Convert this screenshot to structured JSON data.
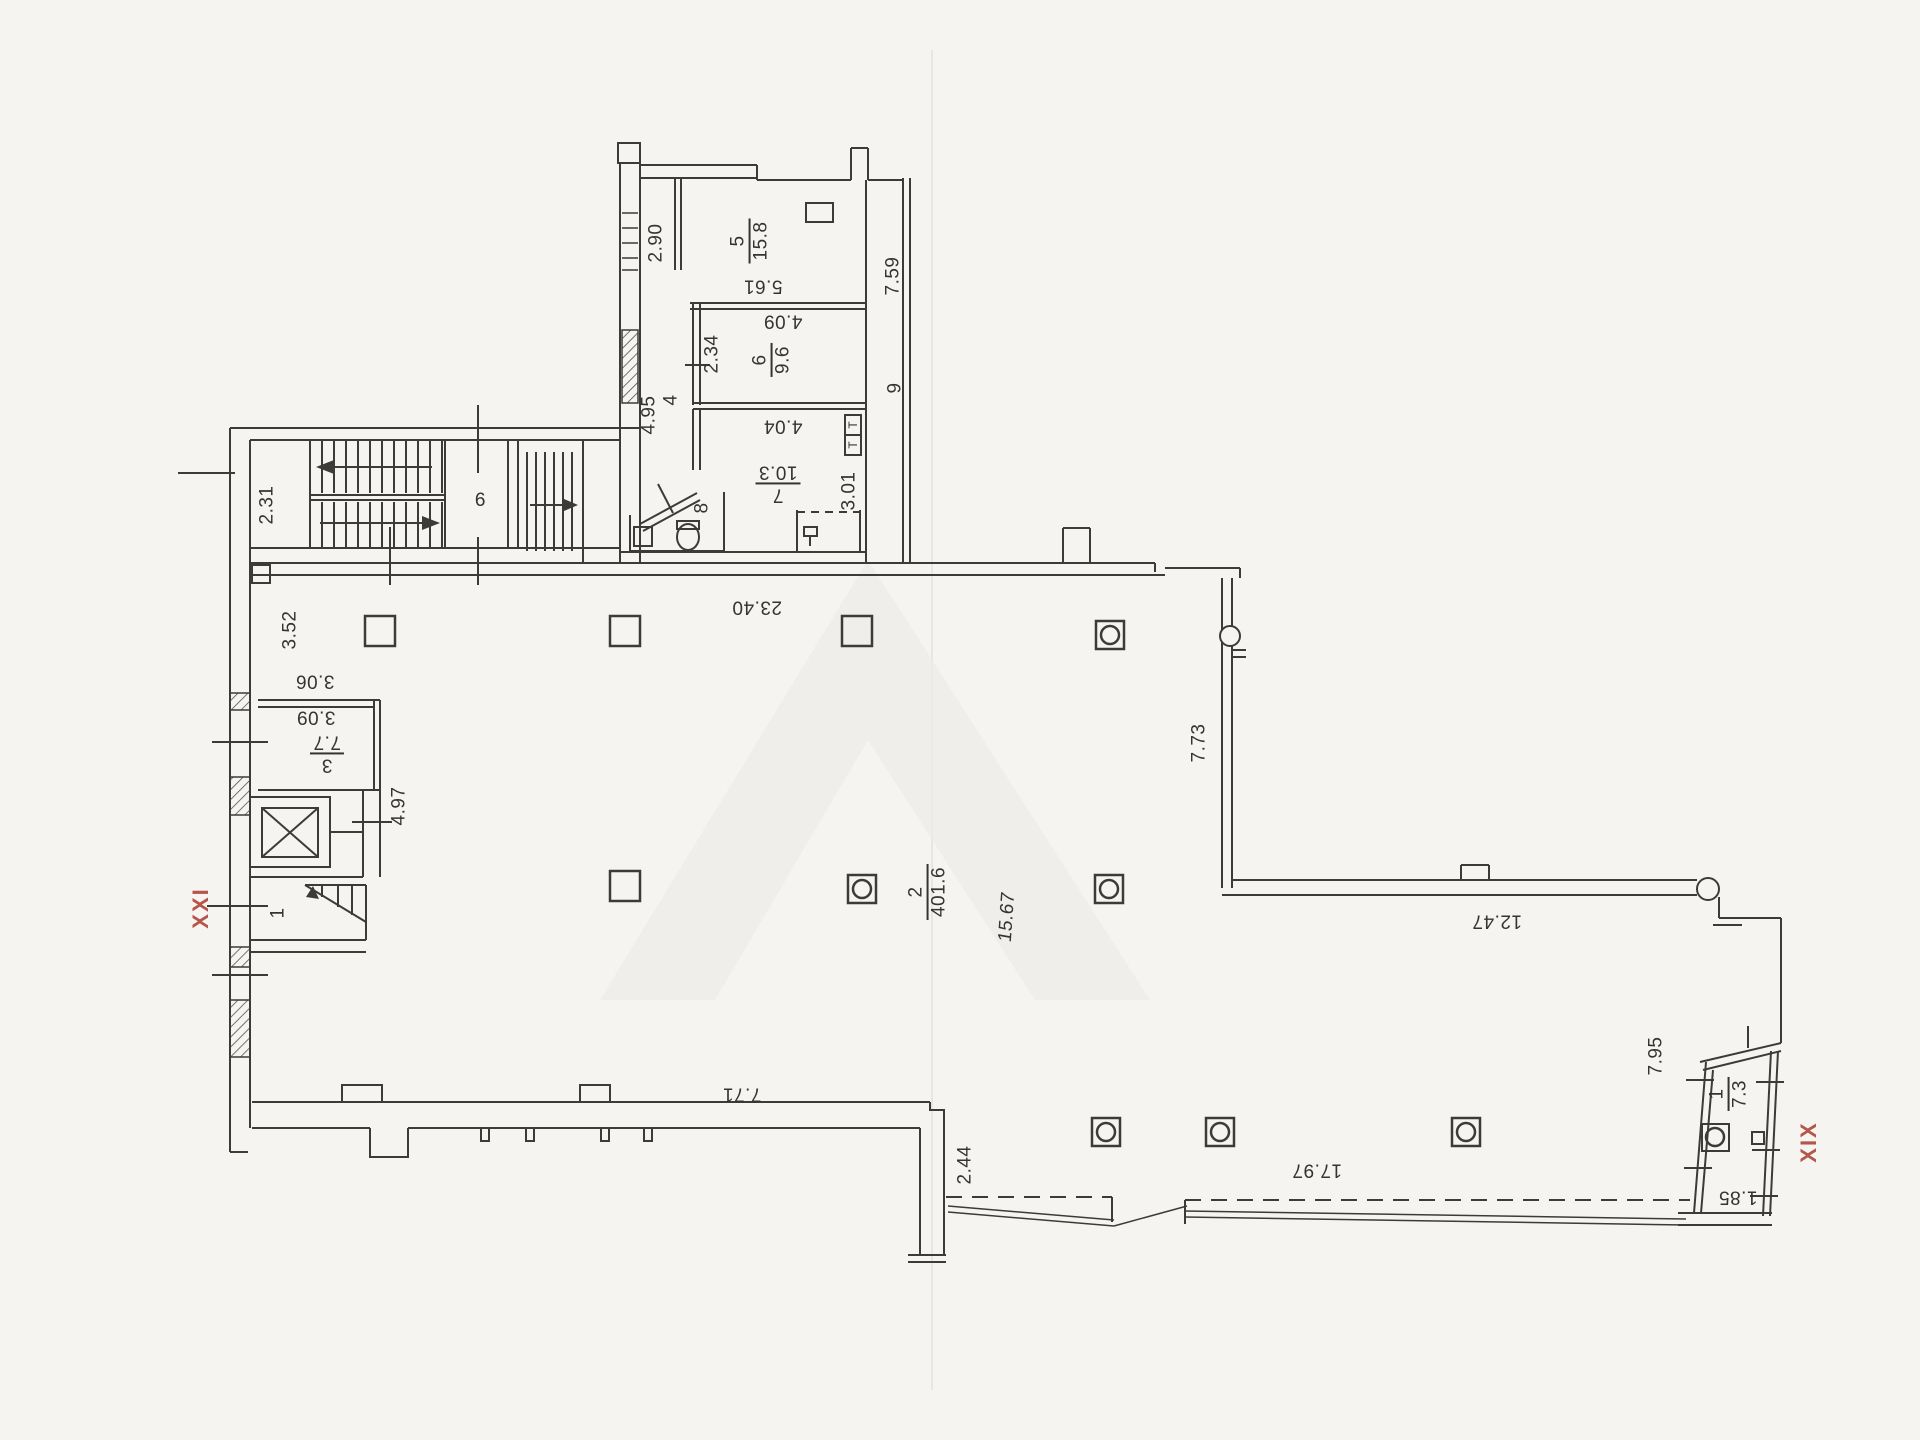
{
  "plan": {
    "sections": {
      "left": "XXI",
      "right": "XIX"
    },
    "rooms": {
      "r1": {
        "number": "1"
      },
      "r2": {
        "number": "2",
        "area": "401.6"
      },
      "r3": {
        "number": "3",
        "area": "7.7"
      },
      "r4": {
        "number": "4"
      },
      "r5": {
        "number": "5",
        "area": "15.8"
      },
      "r6": {
        "number": "6",
        "area": "9.6"
      },
      "r7": {
        "number": "7",
        "area": "10.3"
      },
      "r8": {
        "number": "8"
      },
      "r9": {
        "number": "9"
      },
      "r9b": {
        "number": "9"
      },
      "rx1": {
        "number": "1",
        "area": "7.3"
      }
    },
    "dimensions": {
      "d2_31": "2.31",
      "d2_90": "2.90",
      "d5_61": "5.61",
      "d4_09": "4.09",
      "d2_34": "2.34",
      "d4_95": "4.95",
      "d4_04": "4.04",
      "d7_59": "7.59",
      "d3_01": "3.01",
      "d23_40": "23.40",
      "d3_52": "3.52",
      "d3_06": "3.06",
      "d3_09": "3.09",
      "d4_97": "4.97",
      "d7_73": "7.73",
      "d12_47": "12.47",
      "d15_67": "15.67",
      "d7_71": "7.71",
      "d2_44": "2.44",
      "d17_97": "17.97",
      "d7_95": "7.95",
      "d1_85": "1.85"
    },
    "duct": {
      "t1": "Т",
      "t2": "Т"
    },
    "colors": {
      "ink": "#3c3b38",
      "section_red": "#b5564b",
      "paper": "#f5f4f1"
    }
  }
}
